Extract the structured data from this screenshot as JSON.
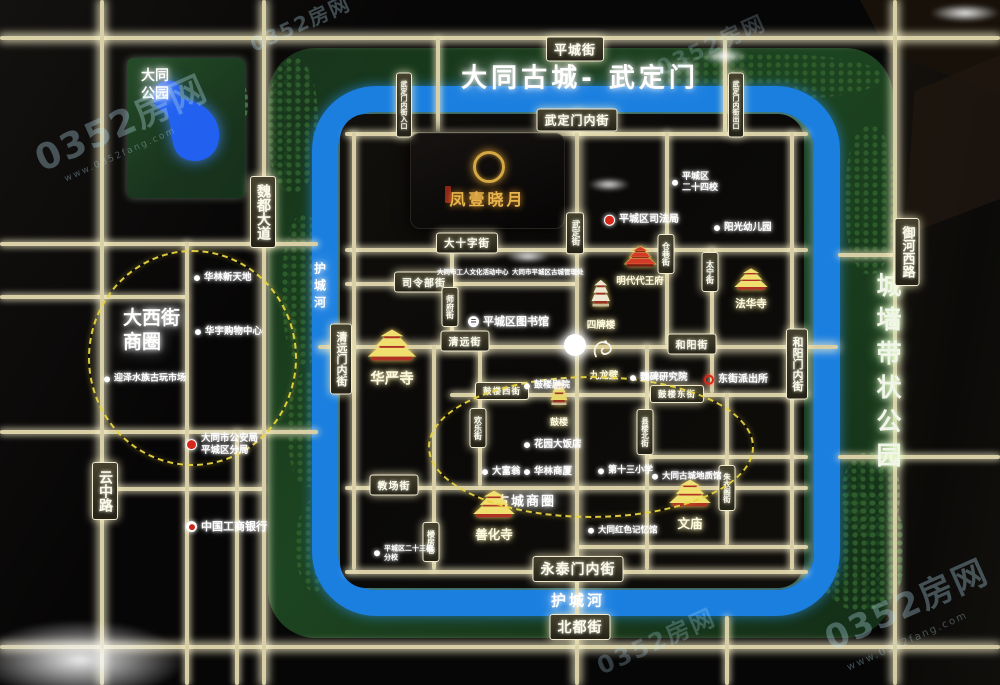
{
  "watermark": {
    "brand": "0352房网",
    "url": "www.0352fang.com"
  },
  "banner": {
    "title": "大同古城- 武定门"
  },
  "project": {
    "name": "凤壹晓月"
  },
  "areas": {
    "datong_park_line1": "大同",
    "datong_park_line2": "公园",
    "wall_park": "城墙带状公园",
    "daxijie_line1": "大西街",
    "daxijie_line2": "商圈",
    "gucheng_cbd": "古城商圈",
    "moat": "护城河"
  },
  "street_signs": [
    "平城街",
    "武定门内街",
    "大十字街",
    "司令部街",
    "清远街",
    "和阳街",
    "鼓楼西街",
    "鼓楼东街",
    "教场街",
    "永泰门内街",
    "北都街",
    "魏都大道",
    "云中路",
    "御河西路",
    "清远门内街",
    "和阳门内街",
    "武定街",
    "师府街",
    "欢乐街",
    "县楼北街",
    "仓巷街",
    "太宁街",
    "朱衣阁街",
    "楼房巷",
    "武定门内街入口",
    "武定门内街出口"
  ],
  "landmarks": [
    "华严寺",
    "善化寺",
    "文庙",
    "法华寺",
    "明代代王府",
    "四牌楼",
    "鼓楼",
    "九龙壁"
  ],
  "pois": [
    {
      "lines": [
        "华林新天地"
      ]
    },
    {
      "lines": [
        "华宇购物中心"
      ]
    },
    {
      "lines": [
        "迎泽水族古玩市场"
      ]
    },
    {
      "lines": [
        "大同市公安局",
        "平城区分局"
      ]
    },
    {
      "lines": [
        "中国工商银行"
      ]
    },
    {
      "lines": [
        "平城区司法局"
      ]
    },
    {
      "lines": [
        "平城区",
        "二十四校"
      ]
    },
    {
      "lines": [
        "阳光幼儿园"
      ]
    },
    {
      "lines": [
        "大同市工人文化活动中心"
      ]
    },
    {
      "lines": [
        "大同市平城区古城管理处"
      ]
    },
    {
      "lines": [
        "平城区图书馆"
      ]
    },
    {
      "lines": [
        "魏碑研究院"
      ]
    },
    {
      "lines": [
        "东街派出所"
      ]
    },
    {
      "lines": [
        "鼓楼剧院"
      ]
    },
    {
      "lines": [
        "花园大饭店"
      ]
    },
    {
      "lines": [
        "大富翁"
      ]
    },
    {
      "lines": [
        "华林商厦"
      ]
    },
    {
      "lines": [
        "第十三小学"
      ]
    },
    {
      "lines": [
        "大同红色记忆馆"
      ]
    },
    {
      "lines": [
        "大同古城地质馆"
      ]
    },
    {
      "lines": [
        "平城区二十三校",
        "分校"
      ]
    }
  ]
}
